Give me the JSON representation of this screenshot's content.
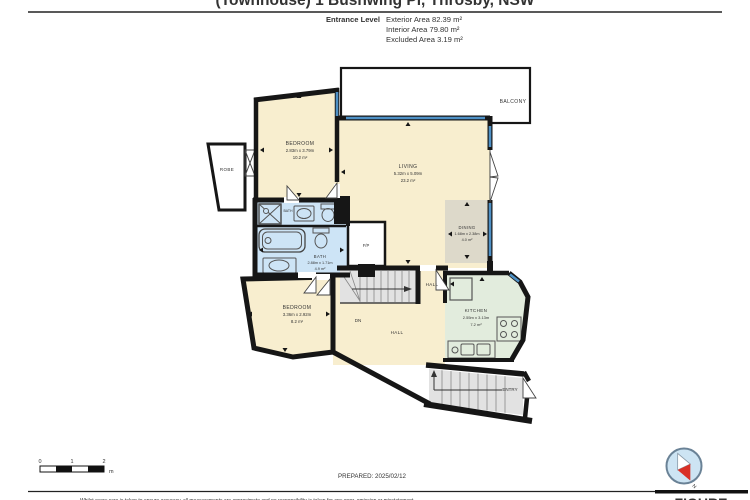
{
  "header": {
    "title": "(Townhouse) 1 Bushwing Pl, Throsby, NSW",
    "level_label": "Entrance Level",
    "areas": [
      {
        "label": "Exterior Area",
        "value": "82.39 m²",
        "full": "Exterior Area 82.39 m²"
      },
      {
        "label": "Interior Area",
        "value": "79.80 m²",
        "full": "Interior Area 79.80 m²"
      },
      {
        "label": "Excluded Area",
        "value": "3.19 m²",
        "full": "Excluded Area 3.19 m²"
      }
    ]
  },
  "plan": {
    "rooms": {
      "balcony": {
        "name": "BALCONY"
      },
      "bedroom1": {
        "name": "BEDROOM",
        "dims": "2.83m x 3.79m",
        "area": "10.2 m²"
      },
      "living": {
        "name": "LIVING",
        "dims": "5.32m x 5.09m",
        "area": "23.2 m²"
      },
      "dining": {
        "name": "DINING",
        "dims": "1.68m x 2.38m",
        "area": "4.0 m²"
      },
      "bath_small": {
        "name": "BATH"
      },
      "bath_main": {
        "name": "BATH",
        "dims": "2.88m x 1.71m",
        "area": "4.9 m²"
      },
      "fireplace": {
        "name": "F/P"
      },
      "robe": {
        "name": "ROBE"
      },
      "bedroom2": {
        "name": "BEDROOM",
        "dims": "3.36m x 2.92m",
        "area": "8.2 m²"
      },
      "hall_upper": {
        "name": "HALL"
      },
      "hall_lower": {
        "name": "HALL"
      },
      "kitchen": {
        "name": "KITCHEN",
        "dims": "2.55m x 3.13m",
        "area": "7.2 m²"
      },
      "stairs_dn": {
        "name": "DN"
      },
      "entry": {
        "name": "ENTRY"
      }
    },
    "colors": {
      "room_cream": "#f8eecf",
      "bath_blue": "#cde4f6",
      "kitchen_green": "#e2ecdd",
      "dining_tan": "#ddd9ca",
      "stairs_gray": "#e2e2e2",
      "wall_black": "#161616",
      "window_blue": "#4e90c5"
    }
  },
  "footer": {
    "scale": {
      "ticks": [
        "0",
        "1",
        "2"
      ],
      "unit": "m"
    },
    "prepared": "PREPARED: 2025/02/12",
    "disclaimer": "Whilst every care is taken to ensure accuracy, all measurements are approximate and no responsibility is taken for any error, omission or misstatement.",
    "logo": {
      "text": "FIGURE",
      "compass_n": "N"
    }
  }
}
